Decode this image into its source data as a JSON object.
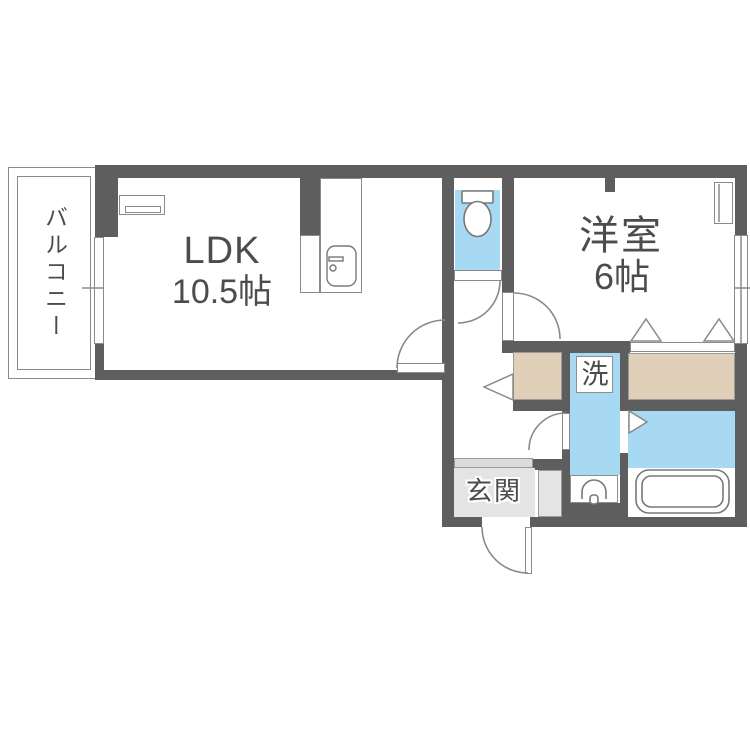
{
  "rooms": {
    "balcony": {
      "label": "バルコニー"
    },
    "ldk": {
      "name": "LDK",
      "size": "10.5帖"
    },
    "western_room": {
      "name": "洋室",
      "size": "6帖"
    },
    "entrance": {
      "label": "玄関"
    },
    "laundry": {
      "label": "洗"
    }
  },
  "icons": {
    "toilet": "toilet-icon",
    "bathtub": "bathtub-icon",
    "washbasin": "washbasin-icon",
    "kitchen_sink": "kitchen-sink-icon",
    "air_conditioner": "air-conditioner-icon",
    "window": "window-symbol",
    "door_swing": "door-swing-symbol",
    "folding_door": "folding-door-symbol"
  },
  "colors": {
    "wall": "#5e5e5e",
    "water_area_blue": "#a8d9f2",
    "closet_beige": "#e1d0b9",
    "entrance_gray": "#e4e4e4",
    "line_gray": "#8a8a8a",
    "text": "#4c4c4c"
  }
}
